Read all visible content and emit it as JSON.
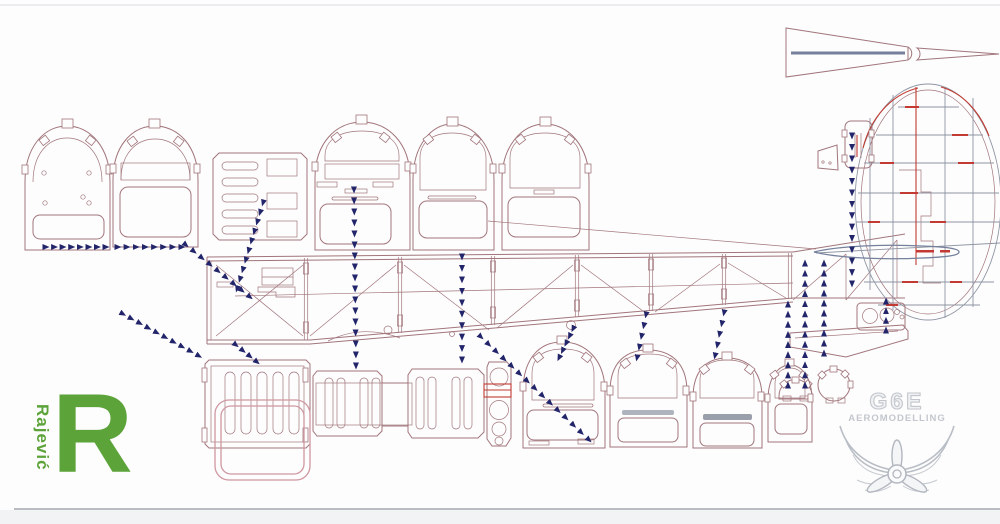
{
  "branding": {
    "rajevic": {
      "vertical_text": "Rajević",
      "initial": "R"
    },
    "g6e": {
      "title": "G6E",
      "subtitle": "AEROMODELLING"
    }
  },
  "colors": {
    "background": "#fdfdfd",
    "outline": "#a1757b",
    "accent_red": "#c23a31",
    "overlay_pink": "#cf97a0",
    "arrow_navy": "#23256b",
    "structure_gray": "#8e95a3",
    "spar_blue_gray": "#75809c",
    "logo_green": "#5ca339",
    "logo_gray": "#c3c7cd",
    "border_gray": "#b9bcc1"
  }
}
